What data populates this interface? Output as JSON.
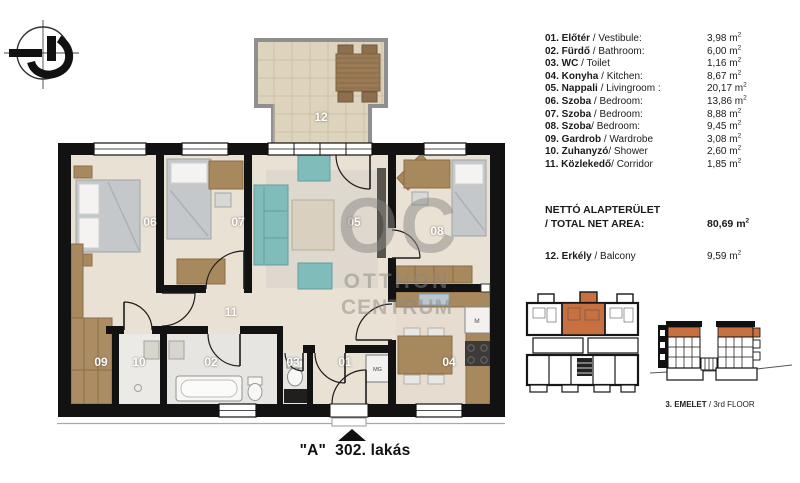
{
  "legend": {
    "unit": " m",
    "sup": "2",
    "rows": [
      {
        "num": "01.",
        "hu": " Előtér",
        "en": " / Vestibule:",
        "area": "3,98"
      },
      {
        "num": "02.",
        "hu": " Fürdő",
        "en": " / Bathroom:",
        "area": "6,00"
      },
      {
        "num": "03.",
        "hu": " WC",
        "en": " / Toilet",
        "area": "1,16"
      },
      {
        "num": "04.",
        "hu": " Konyha",
        "en": " / Kitchen:",
        "area": "8,67"
      },
      {
        "num": "05.",
        "hu": " Nappali",
        "en": " / Livingroom :",
        "area": "20,17"
      },
      {
        "num": "06.",
        "hu": " Szoba",
        "en": " / Bedroom:",
        "area": "13,86"
      },
      {
        "num": "07.",
        "hu": " Szoba",
        "en": " / Bedroom:",
        "area": "8,88"
      },
      {
        "num": "08.",
        "hu": " Szoba",
        "en": "/ Bedroom:",
        "area": "9,45"
      },
      {
        "num": "09.",
        "hu": " Gardrob",
        "en": " / Wardrobe",
        "area": "3,08"
      },
      {
        "num": "10.",
        "hu": " Zuhanyzó",
        "en": "/ Shower",
        "area": "2,60"
      },
      {
        "num": "11.",
        "hu": " Közlekedő",
        "en": "/ Corridor",
        "area": "1,85"
      }
    ],
    "total": {
      "line1": "NETTÓ ALAPTERÜLET",
      "line2": "/ TOTAL NET AREA:",
      "area": "80,69"
    },
    "balcony_row": {
      "num": "12.",
      "hu": " Erkély",
      "en": " / Balcony",
      "area": "9,59"
    }
  },
  "plan": {
    "room_numbers": {
      "r01": "01",
      "r02": "02",
      "r03": "03",
      "r04": "04",
      "r05": "05",
      "r06": "06",
      "r07": "07",
      "r08": "08",
      "r09": "09",
      "r10": "10",
      "r11": "11",
      "r12": "12"
    },
    "appliances": {
      "washing_machine": "MG",
      "fridge": "M"
    },
    "watermark": {
      "logo": "OC",
      "line1": "OTTHON",
      "line2": "CENTRUM"
    }
  },
  "keyplan_caption": {
    "bold": "3. EMELET",
    "rest": " / 3rd FLOOR"
  },
  "footer": {
    "unit_label": "\"A\"",
    "gap": "  ",
    "apartment": "302. lakás"
  },
  "colors": {
    "highlight_orange": "#c8703f",
    "wall_black": "#121212",
    "floor_beige": "#e9e2d4",
    "teal": "#7fbcba",
    "furniture_brown": "#a8885d"
  }
}
